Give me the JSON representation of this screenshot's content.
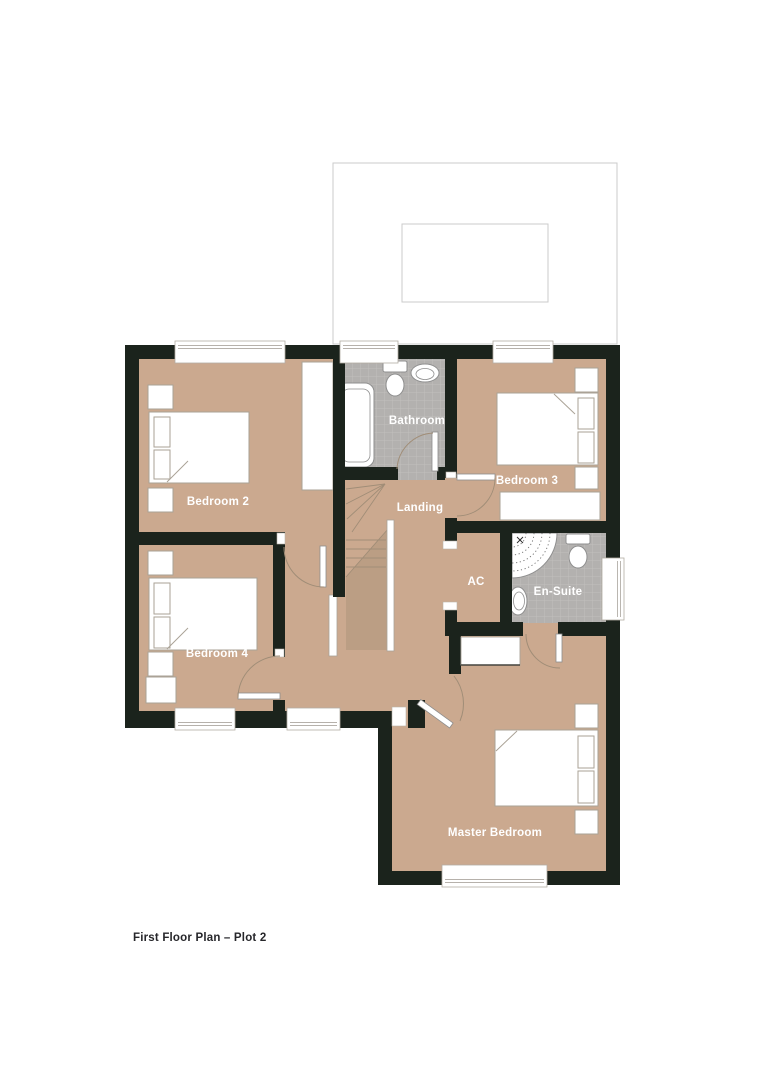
{
  "plan": {
    "caption": "First Floor Plan – Plot 2",
    "rooms": [
      {
        "name": "Bedroom 2"
      },
      {
        "name": "Bathroom"
      },
      {
        "name": "Bedroom 3"
      },
      {
        "name": "Landing"
      },
      {
        "name": "AC"
      },
      {
        "name": "En-Suite"
      },
      {
        "name": "Bedroom 4"
      },
      {
        "name": "Master Bedroom"
      }
    ],
    "colors": {
      "wall": "#1b231c",
      "floor": "#cba98f",
      "stair_shadow": "#bb9e84",
      "tile": "#b3b1af",
      "tile_grid": "#c2bfbc",
      "room_label": "#ffffff",
      "caption": "#26262a",
      "roof_outline": "#cbcbcb"
    }
  }
}
